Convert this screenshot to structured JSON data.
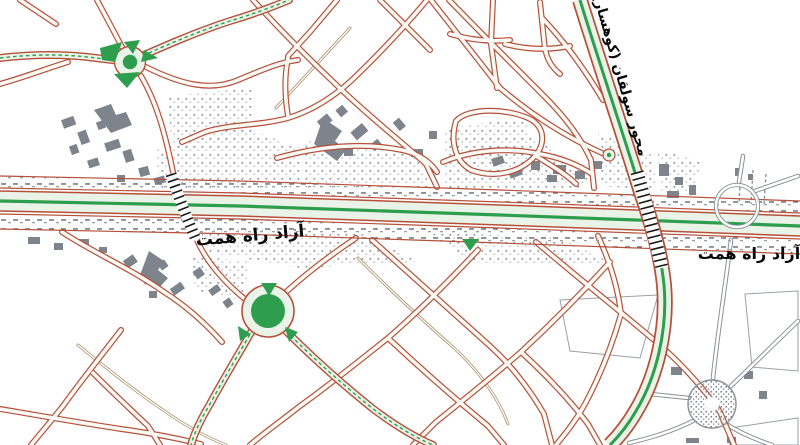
{
  "map": {
    "kind": "urban-road-map",
    "labels": {
      "freeway_center": "آزاد راه همت",
      "freeway_right": "آزاد راه همت",
      "diagonal_axis": "محور سولقان (کوهسار)"
    },
    "colors": {
      "background": "#ffffff",
      "street_casing_red": "#b5503a",
      "street_inner": "#fcfaf5",
      "highway_fill": "#e9f3e7",
      "highway_centerline_green": "#2e9e4e",
      "roundabout_green": "#2e9e4e",
      "building_gray": "#7d848c",
      "unpaved_road_gray": "#8a9196",
      "dirt_path_tan": "#9b7e55",
      "bridge_hatch_black": "#1a1a1a",
      "label_text": "#0a0a0a"
    },
    "features": {
      "roundabouts": [
        {
          "name": "northwest-roundabout",
          "x": 130,
          "y": 62
        },
        {
          "name": "central-roundabout",
          "x": 268,
          "y": 311
        },
        {
          "name": "mini-roundabout-on-axis",
          "x": 609,
          "y": 155
        },
        {
          "name": "gray-stippled-roundabout",
          "x": 712,
          "y": 404
        },
        {
          "name": "gray-interchange-ring",
          "x": 737,
          "y": 206
        }
      ],
      "bridges": [
        {
          "name": "west-overpass",
          "x": 183,
          "y": 206
        },
        {
          "name": "sulqan-axis-overpass",
          "x": 649,
          "y": 220
        }
      ],
      "highways": [
        {
          "name": "hemmat-freeway",
          "orientation": "horizontal"
        },
        {
          "name": "sulqan-axis",
          "orientation": "diagonal"
        }
      ]
    }
  }
}
